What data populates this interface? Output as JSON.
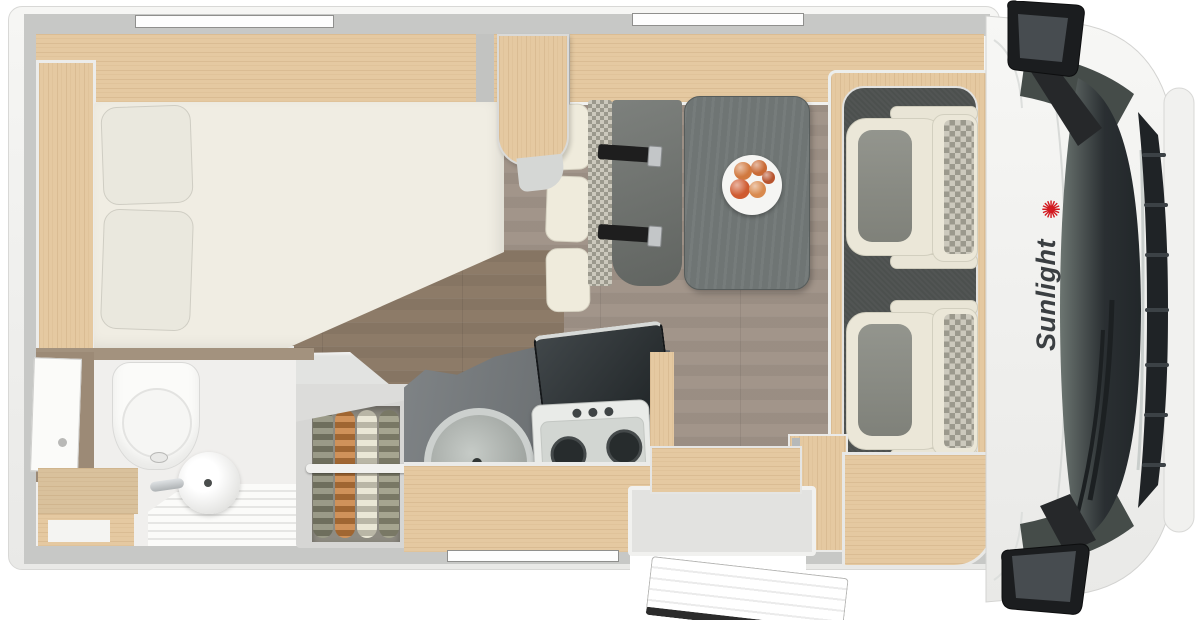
{
  "branding": {
    "name": "Sunlight",
    "logo_glyph": "✺",
    "logo_color": "#d2191f",
    "text_color": "#3b3f42"
  },
  "palette": {
    "body": "#f3f3f1",
    "wall": "#c7c8c6",
    "wood": "#e5c9a1",
    "wood_taupe": "#a3927e",
    "floor": "#a2958a",
    "floor_dark": "#8d7b68",
    "counter": "#6a6f72",
    "table": "#6f7574",
    "bench": "#6e726e",
    "platform": "#4c504e",
    "seat_cream": "#ebe7d8",
    "seat_grey": "#8a8c84",
    "stove": "#e9ebe8",
    "burner": "#272c2d",
    "windshield": "#262b2e",
    "grille": "#1f2326",
    "mirror_black": "#202225",
    "door_seal": "#2b2b2b"
  },
  "wardrobe_clothes": [
    "#8a8a74",
    "#c8803f",
    "#e7e3cf",
    "#97967e"
  ],
  "fruit_colors": [
    "#d1793f",
    "#c96a35",
    "#cf5b31",
    "#d98a4e",
    "#b8542e"
  ]
}
